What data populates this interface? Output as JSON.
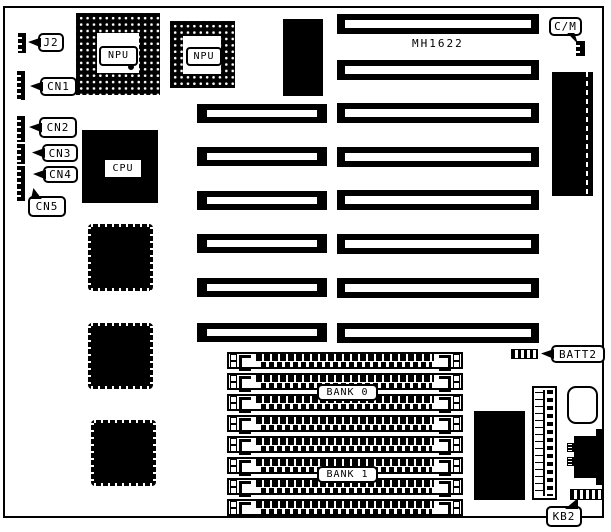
{
  "board": {
    "model_text": "MH1622"
  },
  "connectors": {
    "j2": "J2",
    "cn1": "CN1",
    "cn2": "CN2",
    "cn3": "CN3",
    "cn4": "CN4",
    "cn5": "CN5",
    "cm": "C/M",
    "batt2": "BATT2",
    "kb2": "KB2"
  },
  "chips": {
    "npu1": "NPU",
    "npu2": "NPU",
    "cpu": "CPU"
  },
  "memory": {
    "bank0": "BANK 0",
    "bank1": "BANK 1",
    "simm_socket_count": 8
  },
  "slots": {
    "left_column_count": 6,
    "right_column_count": 8
  },
  "colors": {
    "ink": "#000000",
    "paper": "#ffffff"
  }
}
